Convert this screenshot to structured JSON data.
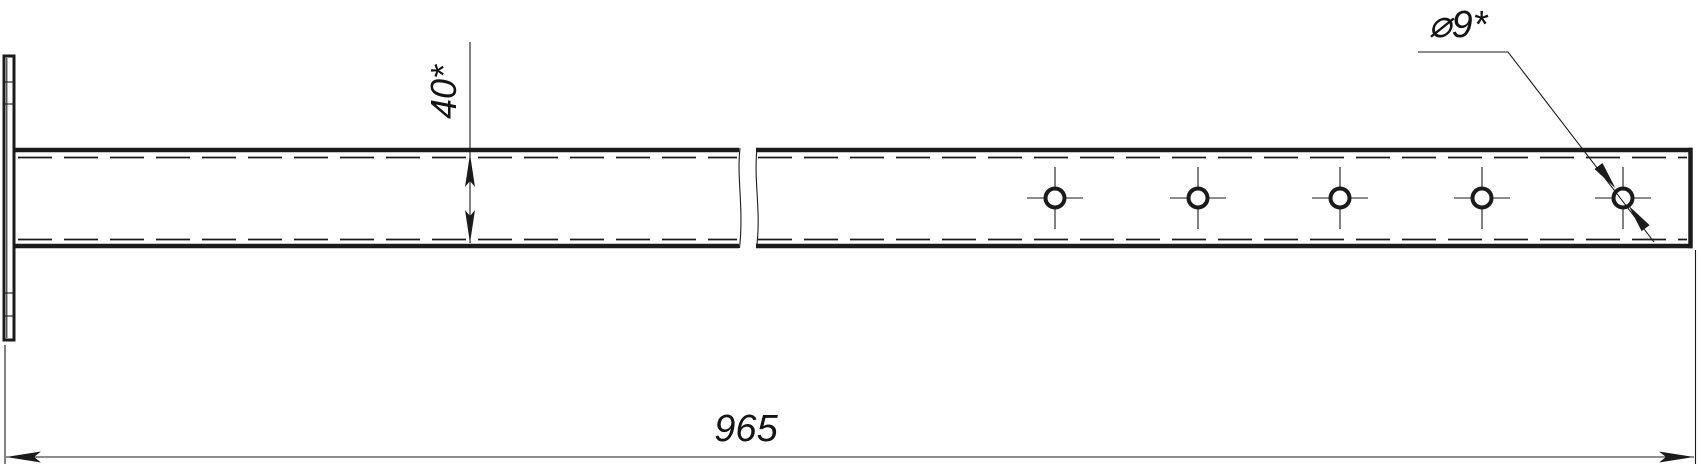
{
  "drawing": {
    "type": "engineering-drawing",
    "description": "Side view of a long flat bar with end plate, mid-length break symbol and five through holes",
    "background_color": "#ffffff",
    "line_color": "#1b1b1b",
    "labels": {
      "overall_length": "965",
      "profile_height": "40*",
      "hole_diameter": "⌀9*"
    },
    "holes": {
      "count": 5,
      "center_y": 198,
      "positions_x": [
        1055,
        1198,
        1340,
        1482,
        1623
      ],
      "outer_radius": 9.5,
      "crosshair_half_h": 28,
      "crosshair_half_v": 31
    }
  }
}
